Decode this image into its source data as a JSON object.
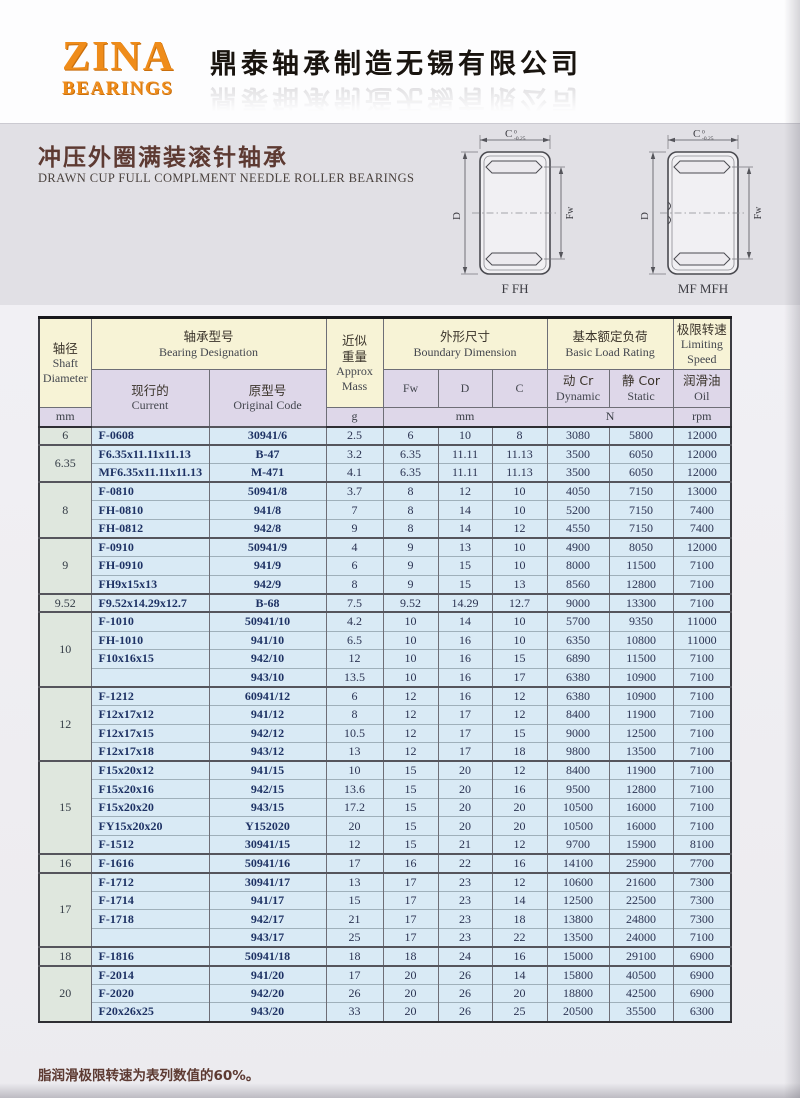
{
  "header": {
    "logo_line1": "ZINA",
    "logo_line2": "BEARINGS",
    "company_name": "鼎泰轴承制造无锡有限公司"
  },
  "title": {
    "zh": "冲压外圈满装滚针轴承",
    "en": "DRAWN CUP FULL COMPLMENT NEEDLE ROLLER BEARINGS"
  },
  "colors": {
    "logo_orange": "#ef8c1a",
    "title_maroon": "#5d3a32",
    "header_cream": "#f7f3d6",
    "header_lavender": "#ded7e9",
    "row_blue": "#d9eaf5",
    "shaft_column_green": "#dfe7de",
    "designation_navy": "#1e3264"
  },
  "diagrams": [
    {
      "caption": "F FH",
      "dim_top": "C",
      "tol_sup": "0",
      "tol_sub": "-0.25",
      "dim_left": "D",
      "dim_right": "Fw"
    },
    {
      "caption": "MF MFH",
      "dim_top": "C",
      "tol_sup": "0",
      "tol_sub": "-0.25",
      "dim_left": "D",
      "dim_right": "Fw"
    }
  ],
  "table": {
    "headers": {
      "shaft_zh": "轴径",
      "shaft_en1": "Shaft",
      "shaft_en2": "Diameter",
      "designation_zh": "轴承型号",
      "designation_en": "Bearing Designation",
      "mass_zh1": "近似",
      "mass_zh2": "重量",
      "mass_en1": "Approx",
      "mass_en2": "Mass",
      "boundary_zh": "外形尺寸",
      "boundary_en": "Boundary Dimension",
      "load_zh": "基本额定负荷",
      "load_en": "Basic Load Rating",
      "speed_zh": "极限转速",
      "speed_en1": "Limiting",
      "speed_en2": "Speed",
      "current_zh": "现行的",
      "current_en": "Current",
      "original_zh": "原型号",
      "original_en": "Original Code",
      "fw": "Fw",
      "d": "D",
      "c": "C",
      "dynamic_zh": "动 Cr",
      "dynamic_en": "Dynamic",
      "static_zh": "静 Cor",
      "static_en": "Static",
      "oil_zh": "润滑油",
      "oil_en": "Oil",
      "unit_shaft": "mm",
      "unit_mass": "g",
      "unit_boundary": "mm",
      "unit_load": "N",
      "unit_speed": "rpm"
    },
    "rows": [
      {
        "shaft": "6",
        "rowspan": 1,
        "cells": [
          "F-0608",
          "30941/6",
          "2.5",
          "6",
          "10",
          "8",
          "3080",
          "5800",
          "12000"
        ]
      },
      {
        "shaft": "6.35",
        "rowspan": 2,
        "cells": [
          "F6.35x11.11x11.13",
          "B-47",
          "3.2",
          "6.35",
          "11.11",
          "11.13",
          "3500",
          "6050",
          "12000"
        ]
      },
      {
        "cells": [
          "MF6.35x11.11x11.13",
          "M-471",
          "4.1",
          "6.35",
          "11.11",
          "11.13",
          "3500",
          "6050",
          "12000"
        ]
      },
      {
        "shaft": "8",
        "rowspan": 3,
        "cells": [
          "F-0810",
          "50941/8",
          "3.7",
          "8",
          "12",
          "10",
          "4050",
          "7150",
          "13000"
        ]
      },
      {
        "cells": [
          "FH-0810",
          "941/8",
          "7",
          "8",
          "14",
          "10",
          "5200",
          "7150",
          "7400"
        ]
      },
      {
        "cells": [
          "FH-0812",
          "942/8",
          "9",
          "8",
          "14",
          "12",
          "4550",
          "7150",
          "7400"
        ]
      },
      {
        "shaft": "9",
        "rowspan": 3,
        "cells": [
          "F-0910",
          "50941/9",
          "4",
          "9",
          "13",
          "10",
          "4900",
          "8050",
          "12000"
        ]
      },
      {
        "cells": [
          "FH-0910",
          "941/9",
          "6",
          "9",
          "15",
          "10",
          "8000",
          "11500",
          "7100"
        ]
      },
      {
        "cells": [
          "FH9x15x13",
          "942/9",
          "8",
          "9",
          "15",
          "13",
          "8560",
          "12800",
          "7100"
        ]
      },
      {
        "shaft": "9.52",
        "rowspan": 1,
        "cells": [
          "F9.52x14.29x12.7",
          "B-68",
          "7.5",
          "9.52",
          "14.29",
          "12.7",
          "9000",
          "13300",
          "7100"
        ]
      },
      {
        "shaft": "10",
        "rowspan": 4,
        "cells": [
          "F-1010",
          "50941/10",
          "4.2",
          "10",
          "14",
          "10",
          "5700",
          "9350",
          "11000"
        ]
      },
      {
        "cells": [
          "FH-1010",
          "941/10",
          "6.5",
          "10",
          "16",
          "10",
          "6350",
          "10800",
          "11000"
        ]
      },
      {
        "cells": [
          "F10x16x15",
          "942/10",
          "12",
          "10",
          "16",
          "15",
          "6890",
          "11500",
          "7100"
        ]
      },
      {
        "cells": [
          "",
          "943/10",
          "13.5",
          "10",
          "16",
          "17",
          "6380",
          "10900",
          "7100"
        ]
      },
      {
        "shaft": "12",
        "rowspan": 4,
        "cells": [
          "F-1212",
          "60941/12",
          "6",
          "12",
          "16",
          "12",
          "6380",
          "10900",
          "7100"
        ]
      },
      {
        "cells": [
          "F12x17x12",
          "941/12",
          "8",
          "12",
          "17",
          "12",
          "8400",
          "11900",
          "7100"
        ]
      },
      {
        "cells": [
          "F12x17x15",
          "942/12",
          "10.5",
          "12",
          "17",
          "15",
          "9000",
          "12500",
          "7100"
        ]
      },
      {
        "cells": [
          "F12x17x18",
          "943/12",
          "13",
          "12",
          "17",
          "18",
          "9800",
          "13500",
          "7100"
        ]
      },
      {
        "shaft": "15",
        "rowspan": 5,
        "cells": [
          "F15x20x12",
          "941/15",
          "10",
          "15",
          "20",
          "12",
          "8400",
          "11900",
          "7100"
        ]
      },
      {
        "cells": [
          "F15x20x16",
          "942/15",
          "13.6",
          "15",
          "20",
          "16",
          "9500",
          "12800",
          "7100"
        ]
      },
      {
        "cells": [
          "F15x20x20",
          "943/15",
          "17.2",
          "15",
          "20",
          "20",
          "10500",
          "16000",
          "7100"
        ]
      },
      {
        "cells": [
          "FY15x20x20",
          "Y152020",
          "20",
          "15",
          "20",
          "20",
          "10500",
          "16000",
          "7100"
        ]
      },
      {
        "cells": [
          "F-1512",
          "30941/15",
          "12",
          "15",
          "21",
          "12",
          "9700",
          "15900",
          "8100"
        ]
      },
      {
        "shaft": "16",
        "rowspan": 1,
        "cells": [
          "F-1616",
          "50941/16",
          "17",
          "16",
          "22",
          "16",
          "14100",
          "25900",
          "7700"
        ]
      },
      {
        "shaft": "17",
        "rowspan": 4,
        "cells": [
          "F-1712",
          "30941/17",
          "13",
          "17",
          "23",
          "12",
          "10600",
          "21600",
          "7300"
        ]
      },
      {
        "cells": [
          "F-1714",
          "941/17",
          "15",
          "17",
          "23",
          "14",
          "12500",
          "22500",
          "7300"
        ]
      },
      {
        "cells": [
          "F-1718",
          "942/17",
          "21",
          "17",
          "23",
          "18",
          "13800",
          "24800",
          "7300"
        ]
      },
      {
        "cells": [
          "",
          "943/17",
          "25",
          "17",
          "23",
          "22",
          "13500",
          "24000",
          "7100"
        ]
      },
      {
        "shaft": "18",
        "rowspan": 1,
        "cells": [
          "F-1816",
          "50941/18",
          "18",
          "18",
          "24",
          "16",
          "15000",
          "29100",
          "6900"
        ]
      },
      {
        "shaft": "20",
        "rowspan": 3,
        "cells": [
          "F-2014",
          "941/20",
          "17",
          "20",
          "26",
          "14",
          "15800",
          "40500",
          "6900"
        ]
      },
      {
        "cells": [
          "F-2020",
          "942/20",
          "26",
          "20",
          "26",
          "20",
          "18800",
          "42500",
          "6900"
        ]
      },
      {
        "cells": [
          "F20x26x25",
          "943/20",
          "33",
          "20",
          "26",
          "25",
          "20500",
          "35500",
          "6300"
        ]
      }
    ]
  },
  "footer": {
    "note": "脂润滑极限转速为表列数值的60%。"
  }
}
